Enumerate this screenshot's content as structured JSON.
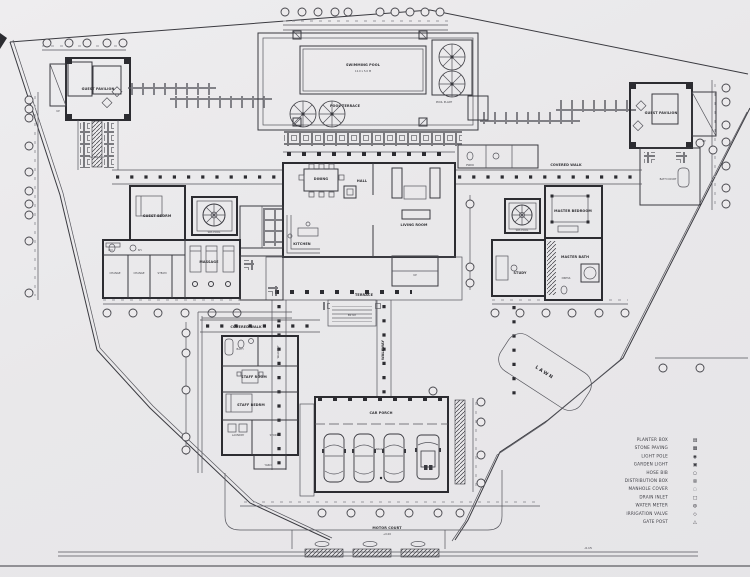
{
  "drawing": {
    "type": "ground floor site plan",
    "paper_color": "#e9e8ea",
    "ink_color": "#2c2c31"
  },
  "labels": {
    "pool_title": "SWIMMING POOL",
    "pool_dims": "12.0 x 5.0 M",
    "pool_deck": "POOL TERRACE",
    "pool_plant": "POOL PLANT",
    "pav_left": "GUEST PAVILION",
    "pav_left_stair": "UP",
    "water_rill": "WATER RILL",
    "pav_right": "GUEST PAVILION",
    "pav_right_stair": "UP",
    "bath_court": "BATH COURT",
    "powder": "PWDR",
    "dining": "DINING",
    "living": "LIVING ROOM",
    "hall": "HALL",
    "kitchen": "KITCHEN",
    "terrace": "TERRACE",
    "entry": "ENTRY",
    "stair_up": "UP",
    "guest_bed": "GUEST BEDRM",
    "plunge_l": "SPA POOL",
    "massage": "MASSAGE",
    "wc": "W.C.",
    "shower": "SH.",
    "change1": "CHANGE",
    "change2": "CHANGE",
    "steam": "STEAM",
    "master_bed": "MASTER BEDROOM",
    "master_bath": "MASTER BATH",
    "spa_r": "SPA POOL",
    "study": "STUDY",
    "dress": "DRESS",
    "covered_walk_l": "COVERED WALK",
    "covered_walk_r": "COVERED WALK",
    "walkway": "WALKWAY",
    "walkway2": "WALKWAY",
    "staff_bath": "BATH",
    "staff_room": "STAFF ROOM",
    "staff_bed": "STAFF BEDRM",
    "laundry": "LAUNDRY",
    "store": "STORE",
    "yard": "YARD",
    "carport": "CAR PORCH",
    "garage": "GARAGE",
    "motor_court": "MOTOR COURT",
    "court_level": "+0.00",
    "lawn": "LAWN",
    "road_level": "-0.15"
  },
  "legend": {
    "items": [
      {
        "symbol": "▤",
        "label": "PLANTER BOX"
      },
      {
        "symbol": "▦",
        "label": "STONE PAVING"
      },
      {
        "symbol": "◉",
        "label": "LIGHT POLE"
      },
      {
        "symbol": "▣",
        "label": "GARDEN LIGHT"
      },
      {
        "symbol": "○",
        "label": "HOSE BIB"
      },
      {
        "symbol": "⊠",
        "label": "DISTRIBUTION BOX"
      },
      {
        "symbol": "◌",
        "label": "MANHOLE COVER"
      },
      {
        "symbol": "□",
        "label": "DRAIN INLET"
      },
      {
        "symbol": "◍",
        "label": "WATER METER"
      },
      {
        "symbol": "◇",
        "label": "IRRIGATION VALVE"
      },
      {
        "symbol": "△",
        "label": "GATE POST"
      }
    ]
  }
}
